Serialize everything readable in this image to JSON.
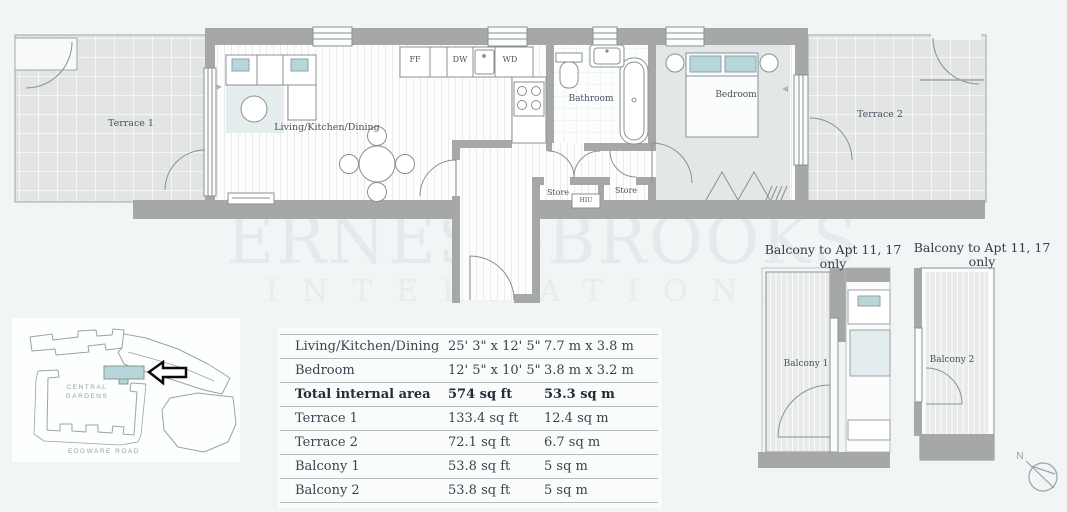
{
  "watermark": {
    "line1": "ERNEST-BROOKS",
    "line2": "INTERNATIONAL"
  },
  "plan": {
    "room_labels": {
      "terrace1": "Terrace 1",
      "living_kitchen_dining": "Living/Kitchen/Dining",
      "bathroom": "Bathroom",
      "bedroom": "Bedroom",
      "terrace2": "Terrace 2",
      "store1": "Store",
      "store2": "Store",
      "hiu": "HIU"
    },
    "appliance_labels": {
      "fridge_freezer": "FF",
      "dishwasher": "DW",
      "washer_dryer": "WD"
    }
  },
  "site_map": {
    "area_label_line1": "CENTRAL",
    "area_label_line2": "GARDENS",
    "road_label": "EDGWARE ROAD"
  },
  "dimensions_table": {
    "rows": [
      {
        "name": "Living/Kitchen/Dining",
        "imperial": "25' 3\" x 12' 5\"",
        "metric": "7.7 m x 3.8 m",
        "bold": false
      },
      {
        "name": "Bedroom",
        "imperial": "12' 5\" x 10' 5\"",
        "metric": "3.8 m x 3.2 m",
        "bold": false
      },
      {
        "name": "Total internal area",
        "imperial": "574 sq ft",
        "metric": "53.3 sq m",
        "bold": true
      },
      {
        "name": "Terrace 1",
        "imperial": "133.4 sq ft",
        "metric": "12.4 sq m",
        "bold": false
      },
      {
        "name": "Terrace 2",
        "imperial": "72.1 sq ft",
        "metric": "6.7 sq m",
        "bold": false
      },
      {
        "name": "Balcony 1",
        "imperial": "53.8 sq ft",
        "metric": "5 sq m",
        "bold": false
      },
      {
        "name": "Balcony 2",
        "imperial": "53.8 sq ft",
        "metric": "5 sq m",
        "bold": false
      }
    ]
  },
  "balcony_plans": {
    "plan1": {
      "title": "Balcony to Apt 11, 17 only",
      "room_label": "Balcony 1"
    },
    "plan2": {
      "title": "Balcony to Apt 11, 17 only",
      "room_label": "Balcony 2"
    }
  },
  "compass": {
    "north_label": "N"
  },
  "colors": {
    "background": "#f1f5f6",
    "wall": "#a5a8a7",
    "accent_teal": "#b7d6da",
    "text": "#39434e",
    "watermark": "#e4eaeb"
  }
}
